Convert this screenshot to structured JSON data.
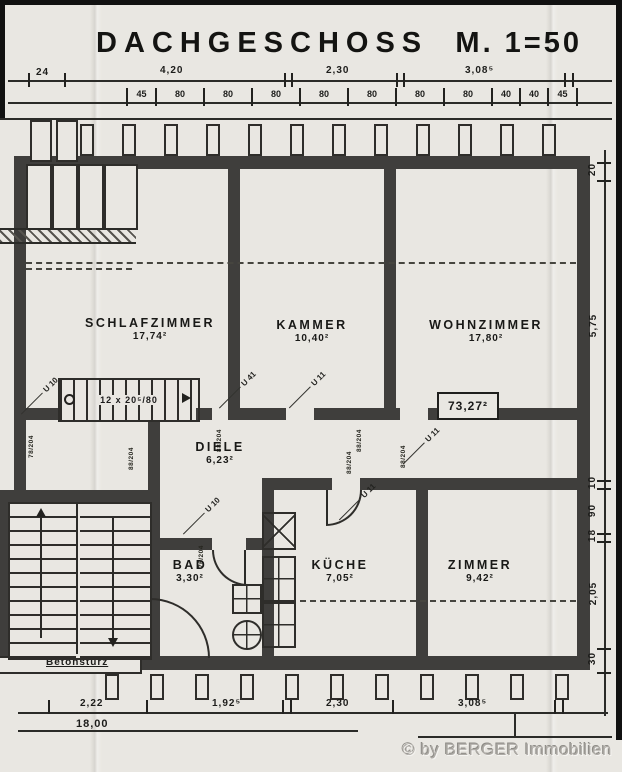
{
  "title": {
    "name": "DACHGESCHOSS",
    "scale": "M. 1=50"
  },
  "top_dims": {
    "small": "24",
    "spans": [
      "4,20",
      "2,30",
      "3,08⁵"
    ],
    "segments": [
      "45",
      "80",
      "80",
      "80",
      "80",
      "80",
      "80",
      "80",
      "40",
      "40",
      "45"
    ]
  },
  "right_dims": [
    "20",
    "5,75",
    "10",
    "90",
    "18",
    "2,05",
    "30"
  ],
  "bottom_dims": {
    "spans": [
      "2,22",
      "1,92⁵",
      "2,30",
      "3,08⁵"
    ],
    "total": "18,00"
  },
  "rooms": {
    "schlafzimmer": {
      "name": "SCHLAFZIMMER",
      "area": "17,74²"
    },
    "kammer": {
      "name": "KAMMER",
      "area": "10,40²"
    },
    "wohnzimmer": {
      "name": "WOHNZIMMER",
      "area": "17,80²"
    },
    "diele": {
      "name": "DIELE",
      "area": "6,23²"
    },
    "bad": {
      "name": "BAD",
      "area": "3,30²"
    },
    "kueche": {
      "name": "KÜCHE",
      "area": "7,05²"
    },
    "zimmer": {
      "name": "ZIMMER",
      "area": "9,42²"
    }
  },
  "total_area": "73,27²",
  "stair_note": "12 x 20⁵/80",
  "beam_labels": [
    "U 10",
    "U 41",
    "U 11",
    "U 11",
    "U 10",
    "U 11"
  ],
  "door_tags": [
    "88/204",
    "88/204",
    "78/204",
    "88/204",
    "88/204",
    "88/204",
    "76/204"
  ],
  "notes": {
    "betonsturz": "Betonsturz"
  },
  "watermark": "© by BERGER Immobilien",
  "colors": {
    "paper": "#e9e7e2",
    "ink": "#1b1b1b",
    "wall": "#3f3e3c",
    "watermark": "#a3a09b"
  }
}
